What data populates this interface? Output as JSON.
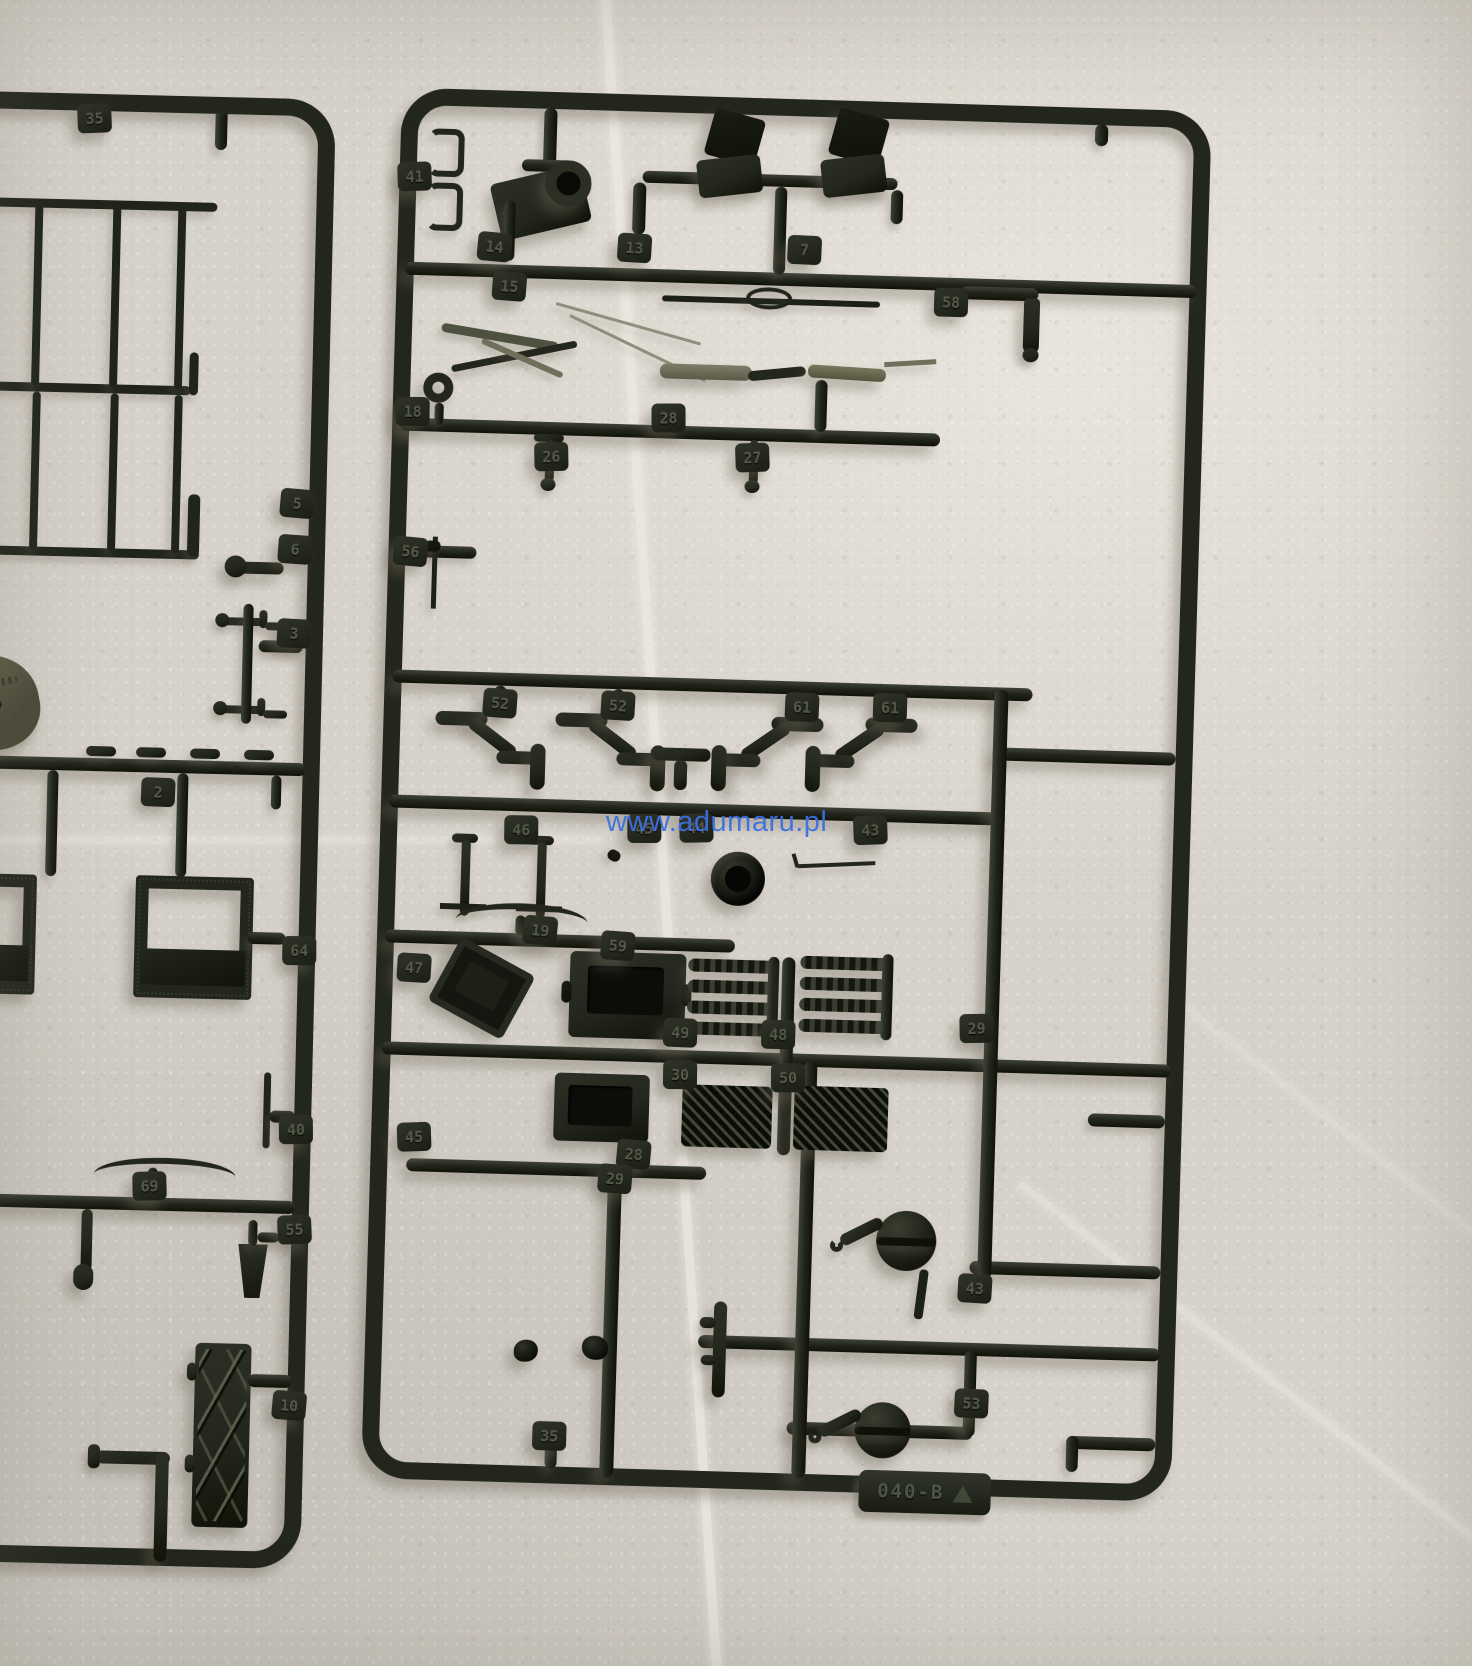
{
  "scene": {
    "subject": "Two dark-green plastic model kit sprues photographed on a light stone tile surface",
    "left_sprue_note": "partially visible, cut off at left image edge",
    "right_sprue_note": "complete rectangular sprue frame with numbered part tabs"
  },
  "watermark": {
    "text": "www.adumaru.pl"
  },
  "right_sprue": {
    "mold_code": "040-B",
    "recycle_icon": "recycling-triangle",
    "part_labels": [
      {
        "text": "41",
        "x": 417,
        "y": 176
      },
      {
        "text": "14",
        "x": 499,
        "y": 244
      },
      {
        "text": "15",
        "x": 515,
        "y": 283
      },
      {
        "text": "13",
        "x": 639,
        "y": 241
      },
      {
        "text": "7",
        "x": 809,
        "y": 238
      },
      {
        "text": "58",
        "x": 957,
        "y": 286
      },
      {
        "text": "18",
        "x": 422,
        "y": 411
      },
      {
        "text": "28",
        "x": 678,
        "y": 410
      },
      {
        "text": "26",
        "x": 562,
        "y": 452
      },
      {
        "text": "27",
        "x": 763,
        "y": 447
      },
      {
        "text": "56",
        "x": 424,
        "y": 551
      },
      {
        "text": "52",
        "x": 518,
        "y": 700
      },
      {
        "text": "52",
        "x": 636,
        "y": 699
      },
      {
        "text": "61",
        "x": 820,
        "y": 695
      },
      {
        "text": "61",
        "x": 908,
        "y": 693
      },
      {
        "text": "46",
        "x": 543,
        "y": 826
      },
      {
        "text": "45",
        "x": 666,
        "y": 821
      },
      {
        "text": "44",
        "x": 718,
        "y": 819
      },
      {
        "text": "43",
        "x": 892,
        "y": 816
      },
      {
        "text": "19",
        "x": 565,
        "y": 926
      },
      {
        "text": "59",
        "x": 643,
        "y": 939
      },
      {
        "text": "47",
        "x": 440,
        "y": 967
      },
      {
        "text": "49",
        "x": 708,
        "y": 1024
      },
      {
        "text": "48",
        "x": 806,
        "y": 1023
      },
      {
        "text": "30",
        "x": 709,
        "y": 1066
      },
      {
        "text": "50",
        "x": 817,
        "y": 1066
      },
      {
        "text": "29",
        "x": 1004,
        "y": 1011
      },
      {
        "text": "45",
        "x": 445,
        "y": 1136
      },
      {
        "text": "28",
        "x": 665,
        "y": 1147
      },
      {
        "text": "29",
        "x": 647,
        "y": 1172
      },
      {
        "text": "43",
        "x": 1010,
        "y": 1271
      },
      {
        "text": "53",
        "x": 1010,
        "y": 1386
      },
      {
        "text": "35",
        "x": 589,
        "y": 1431
      }
    ]
  },
  "left_sprue": {
    "part_labels": [
      {
        "text": "35",
        "x": 95,
        "y": 118
      },
      {
        "text": "5",
        "x": 307,
        "y": 498
      },
      {
        "text": "6",
        "x": 306,
        "y": 544
      },
      {
        "text": "3",
        "x": 307,
        "y": 628
      },
      {
        "text": "2",
        "x": 175,
        "y": 790
      },
      {
        "text": "8",
        "x": -8,
        "y": 800
      },
      {
        "text": "64",
        "x": 320,
        "y": 945
      },
      {
        "text": "40",
        "x": 321,
        "y": 1124
      },
      {
        "text": "69",
        "x": 176,
        "y": 1184
      },
      {
        "text": "55",
        "x": 322,
        "y": 1224
      },
      {
        "text": "10",
        "x": 321,
        "y": 1400
      }
    ]
  },
  "palette": {
    "plastic": "#23261d",
    "plastic_highlight": "#3e4236",
    "plastic_mid": "#2c3024",
    "plastic_shadow": "#101207",
    "tab_text": "#545a47",
    "olive": "#6f6f5b",
    "olive_light": "#8f8e7c",
    "background": "#d6d2ca",
    "background_light": "#e9e5dd",
    "background_dark": "#c4c0b8",
    "grout": "#efebe3",
    "watermark": "#3c70e2",
    "shadow": "rgba(108,99,86,0.42)"
  }
}
